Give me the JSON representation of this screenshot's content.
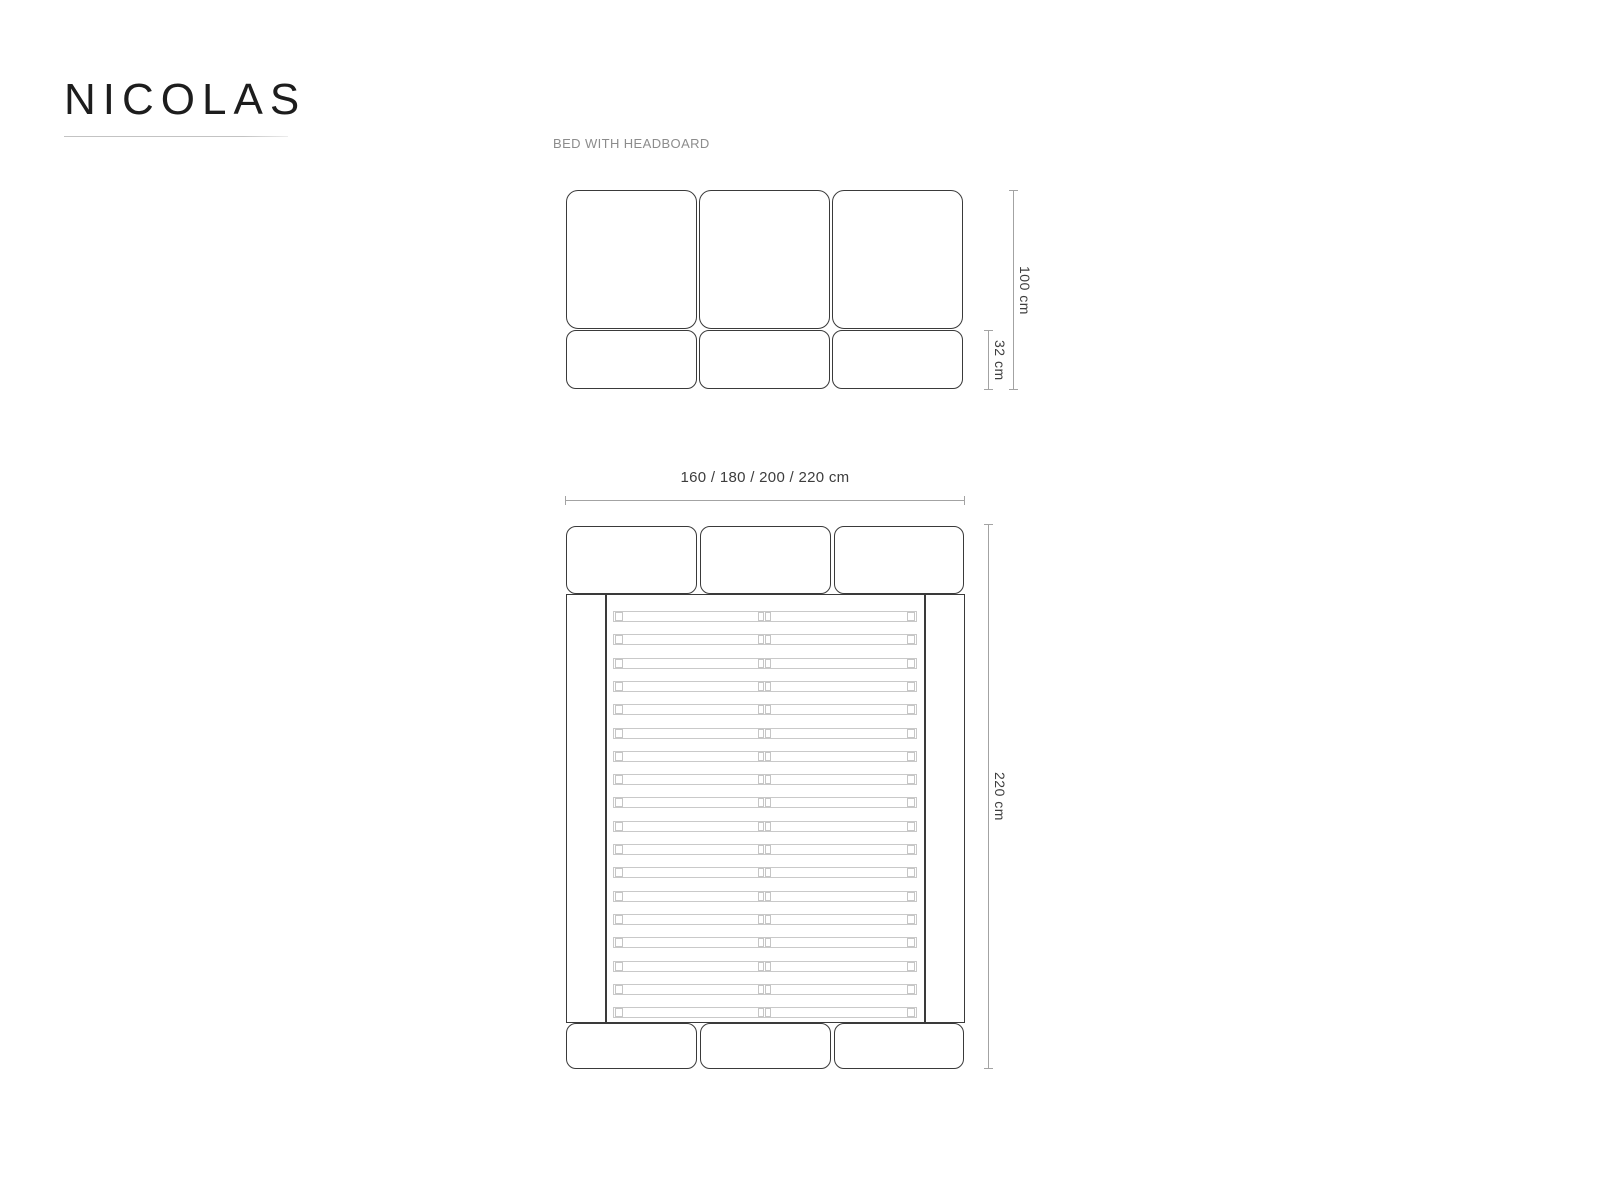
{
  "brand": {
    "title": "NICOLAS"
  },
  "subtitle": "BED WITH HEADBOARD",
  "front_view": {
    "description": "headboard front elevation, three upholstered panels over three base panels",
    "panel_count": 3,
    "base_panel_count": 3,
    "dims": {
      "total_height": "100 cm",
      "base_height": "32 cm"
    }
  },
  "plan_view": {
    "description": "bed top plan with slatted base, headboard cushions and footer cushions",
    "headboard_panel_count": 3,
    "footer_panel_count": 3,
    "slats": {
      "count": 18,
      "halves_per_slat": 2
    },
    "dims": {
      "width_options": "160 / 180 / 200 / 220 cm",
      "length": "220 cm"
    }
  },
  "colors": {
    "background": "#ffffff",
    "outline": "#3a3a3a",
    "slat_outline": "#c9c9c9",
    "dimension_line": "#a3a3a3",
    "dimension_text": "#3d3d3d",
    "subtitle_text": "#8c8c8c",
    "title_text": "#1d1d1d",
    "title_underline": "#c3c3c3"
  }
}
